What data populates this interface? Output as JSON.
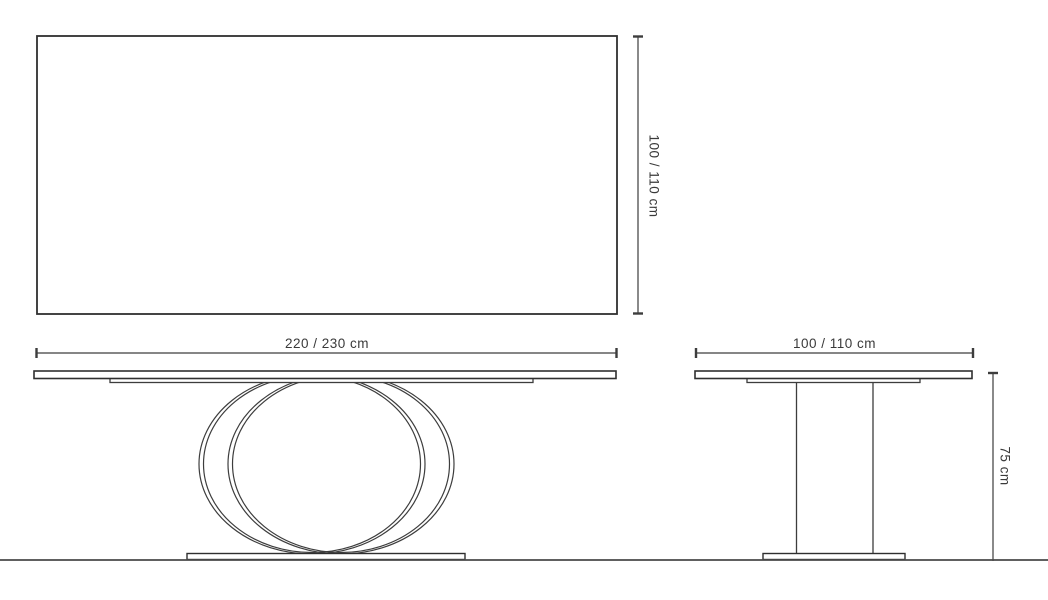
{
  "labels": {
    "plan_depth": "100 / 110 cm",
    "front_width": "220 / 230 cm",
    "side_width": "100 / 110 cm",
    "side_height": "75 cm"
  },
  "colors": {
    "background": "#ffffff",
    "outline": "#2f2f2f",
    "line": "#3d3d3d",
    "ground": "#4a4a4a",
    "text": "#3a3a3a"
  }
}
